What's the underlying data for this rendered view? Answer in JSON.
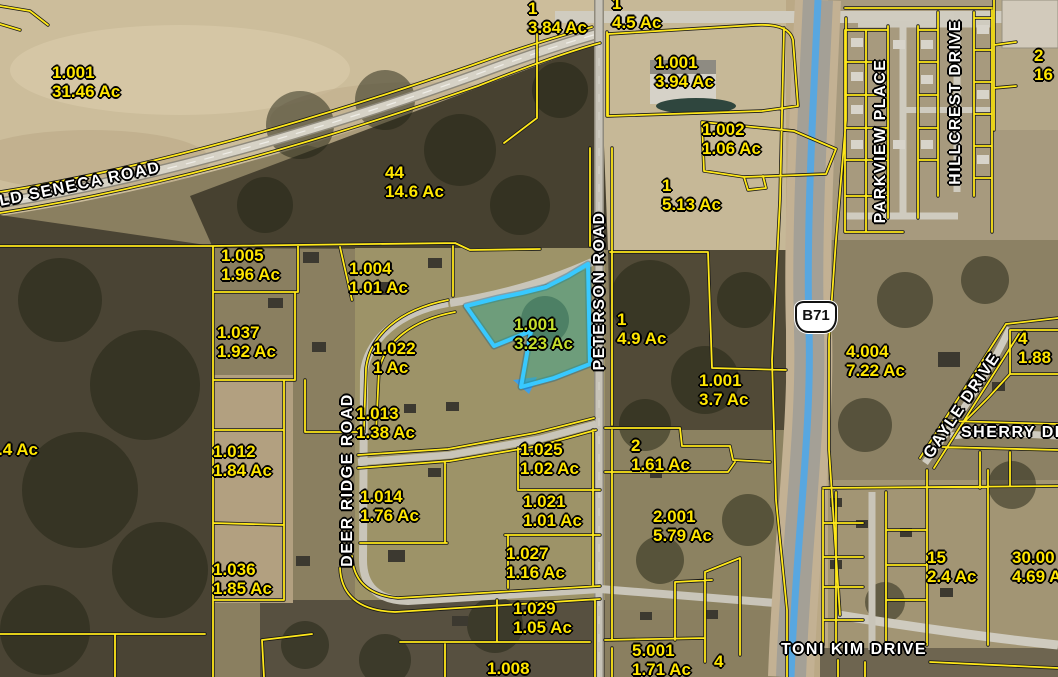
{
  "map": {
    "highway_shield": {
      "label": "B71"
    },
    "highlighted_parcel": {
      "id": "1.001",
      "area": "3.23 Ac"
    },
    "parcels": [
      {
        "id": "1.001",
        "area": "31.46 Ac"
      },
      {
        "id": "1",
        "area": "3.84 Ac"
      },
      {
        "id": "1",
        "area": "4.5 Ac"
      },
      {
        "id": "1.001",
        "area": "3.94 Ac"
      },
      {
        "id": "1.002",
        "area": "1.06 Ac"
      },
      {
        "id": "1",
        "area": "5.13 Ac"
      },
      {
        "id": "2",
        "area": "16"
      },
      {
        "id": "44",
        "area": "14.6 Ac"
      },
      {
        "id": "1.005",
        "area": "1.96 Ac"
      },
      {
        "id": "1.004",
        "area": "1.01 Ac"
      },
      {
        "id": "1.037",
        "area": "1.92 Ac"
      },
      {
        "id": "1.022",
        "area": "1 Ac"
      },
      {
        "id": "1",
        "area": "4.9 Ac"
      },
      {
        "id": "1.001",
        "area": "3.7 Ac"
      },
      {
        "id": "4.004",
        "area": "7.22 Ac"
      },
      {
        "id": "4",
        "area": "1.88"
      },
      {
        "id": "1.013",
        "area": "1.38 Ac"
      },
      {
        "id": "1.012",
        "area": "1.84 Ac"
      },
      {
        "id": "1.025",
        "area": "1.02 Ac"
      },
      {
        "id": "1.014",
        "area": "1.76 Ac"
      },
      {
        "id": "1.021",
        "area": "1.01 Ac"
      },
      {
        "id": "2",
        "area": "1.61 Ac"
      },
      {
        "id": "1.027",
        "area": "1.16 Ac"
      },
      {
        "id": "2.001",
        "area": "5.79 Ac"
      },
      {
        "id": "1.029",
        "area": "1.05 Ac"
      },
      {
        "id": "1.036",
        "area": "1.85 Ac"
      },
      {
        "id": "15",
        "area": "2.4 Ac"
      },
      {
        "id": "30.00",
        "area": "4.69 A"
      },
      {
        "id": "5.001",
        "area": "1.71 Ac"
      },
      {
        "id": "4",
        "area": ""
      },
      {
        "id": "1.008",
        "area": ""
      },
      {
        "id": ".4 Ac",
        "area": ""
      }
    ],
    "roads": [
      {
        "name": "OLD SENECA ROAD"
      },
      {
        "name": "PETERSON ROAD"
      },
      {
        "name": "DEER RIDGE ROAD"
      },
      {
        "name": "PARKVIEW PLACE"
      },
      {
        "name": "HILLCREST DRIVE"
      },
      {
        "name": "GAYLE DRIVE"
      },
      {
        "name": "SHERRY DRIVE"
      },
      {
        "name": "TONI KIM DRIVE"
      }
    ],
    "colors": {
      "parcel_line": "#ffe81a",
      "parcel_label": "#ffe600",
      "road_label": "#ffffff",
      "highlight_stroke": "#38c9ff",
      "highlight_fill": "rgba(58,170,145,0.48)",
      "highlight_label": "#c6df2b",
      "highway_blue": "#58a7e0"
    }
  }
}
